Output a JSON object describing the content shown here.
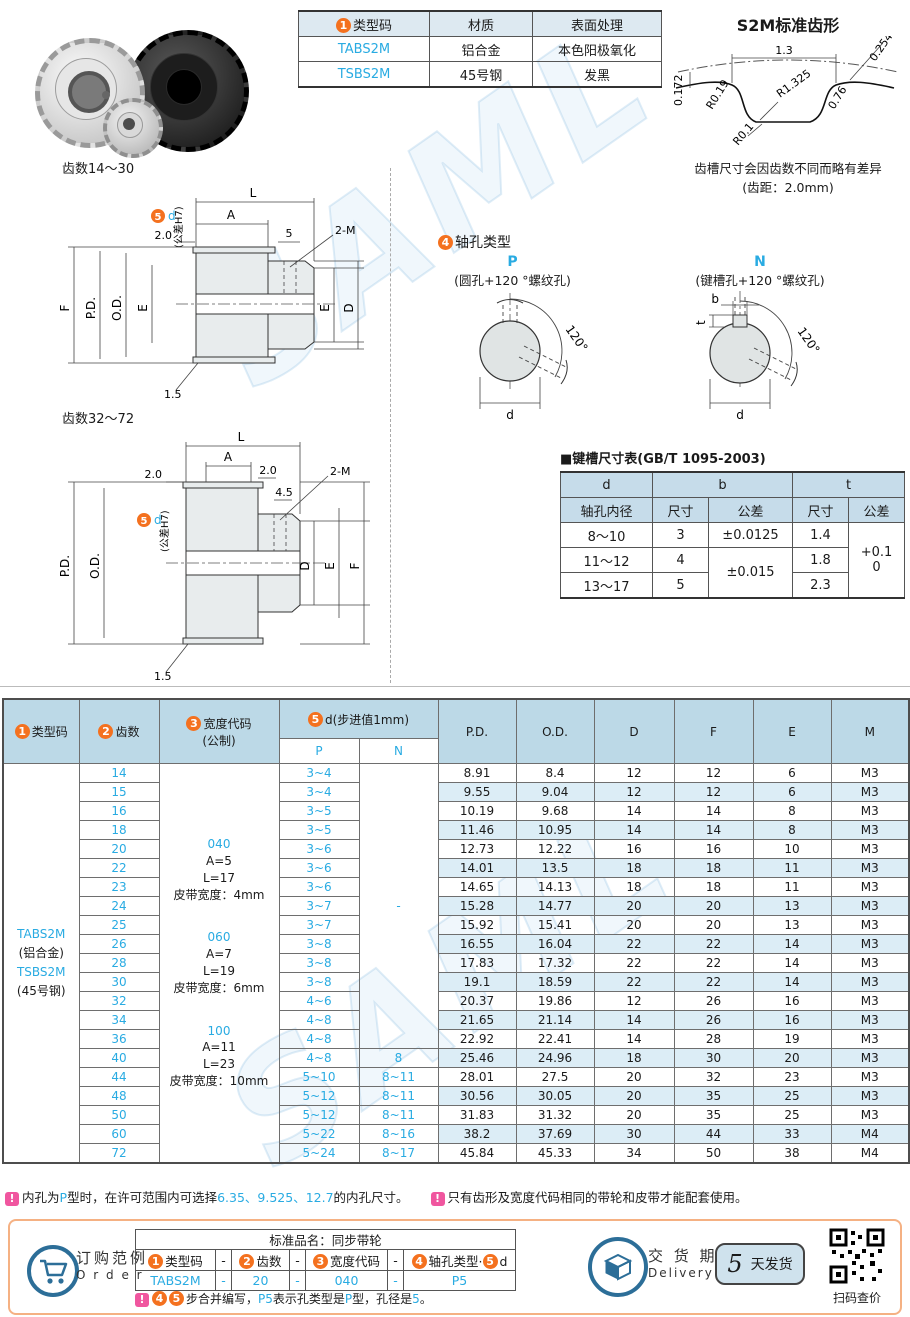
{
  "watermark_text": "SAML",
  "materials_table": {
    "circ": "1",
    "headers": {
      "type": "类型码",
      "material": "材质",
      "surface": "表面处理"
    },
    "rows": [
      {
        "code": "TABS2M",
        "material": "铝合金",
        "surface": "本色阳极氧化"
      },
      {
        "code": "TSBS2M",
        "material": "45号钢",
        "surface": "发黑"
      }
    ]
  },
  "tooth_profile": {
    "title": "S2M标准齿形",
    "dims": {
      "pitch": "1.3",
      "depth": "0.254",
      "r_main": "R1.325",
      "r_tip": "R0.19",
      "flank": "0.76",
      "land": "0.172",
      "r_root": "R0.1"
    },
    "note1": "齿槽尺寸会因齿数不同而略有差异",
    "note2": "(齿距：2.0mm)"
  },
  "drawing1": {
    "title": "齿数14～30",
    "L": "L",
    "A": "A",
    "f20": "2.0",
    "s5": "5",
    "m": "2-M",
    "F": "F",
    "PD": "P.D.",
    "OD": "O.D.",
    "E": "E",
    "E2": "E",
    "D": "D",
    "edge15": "1.5",
    "circ": "5",
    "d": "d",
    "tol": "(公差H7)"
  },
  "drawing2": {
    "title": "齿数32～72",
    "L": "L",
    "A": "A",
    "l20": "2.0",
    "r20": "2.0",
    "s45": "4.5",
    "m": "2-M",
    "PD": "P.D.",
    "OD": "O.D.",
    "D": "D",
    "E": "E",
    "F": "F",
    "edge15": "1.5",
    "circ": "5",
    "d": "d",
    "tol": "(公差H7)"
  },
  "shaft_hole": {
    "circ": "4",
    "title": "轴孔类型",
    "p": {
      "code": "P",
      "desc": "(圆孔+120 °螺纹孔)",
      "angle": "120°",
      "d": "d"
    },
    "n": {
      "code": "N",
      "desc": "(键槽孔+120 °螺纹孔)",
      "angle": "120°",
      "d": "d",
      "b": "b",
      "t": "t"
    }
  },
  "keyway_table": {
    "title": "■键槽尺寸表(GB/T 1095-2003)",
    "h_d": "d",
    "h_d_sub": "轴孔内径",
    "h_b": "b",
    "h_t": "t",
    "h_size_b": "尺寸",
    "h_tol_b": "公差",
    "h_size_t": "尺寸",
    "h_tol_t": "公差",
    "r1": {
      "d": "8～10",
      "b": "3",
      "b_tol": "±0.0125",
      "t": "1.4"
    },
    "r2": {
      "d": "11～12",
      "b": "4",
      "b_tol": "±0.015",
      "t": "1.8"
    },
    "r3": {
      "d": "13～17",
      "b": "5",
      "t": "2.3"
    },
    "t_tol1": "+0.1",
    "t_tol2": "0"
  },
  "main_table": {
    "circ1": "1",
    "circ2": "2",
    "circ3": "3",
    "circ5": "5",
    "h_type": "类型码",
    "h_teeth": "齿数",
    "h_width1": "宽度代码",
    "h_width2": "(公制)",
    "h_d": "d(步进值1mm)",
    "h_p": "P",
    "h_n": "N",
    "h_pd": "P.D.",
    "h_od": "O.D.",
    "h_D": "D",
    "h_F": "F",
    "h_E": "E",
    "h_M": "M",
    "type_cell": [
      {
        "text": "TABS2M",
        "cyan": true
      },
      {
        "text": "(铝合金)"
      },
      {
        "text": "TSBS2M",
        "cyan": true
      },
      {
        "text": "(45号钢)"
      }
    ],
    "width_groups": [
      {
        "code": "040",
        "a": "A=5",
        "l": "L=17",
        "belt": "皮带宽度：4mm"
      },
      {
        "code": "060",
        "a": "A=7",
        "l": "L=19",
        "belt": "皮带宽度：6mm"
      },
      {
        "code": "100",
        "a": "A=11",
        "l": "L=23",
        "belt": "皮带宽度：10mm"
      }
    ],
    "n_merged_text": "-",
    "rows": [
      {
        "teeth": "14",
        "p": "3~4",
        "n_span": 15,
        "pd": "8.91",
        "od": "8.4",
        "d": "12",
        "f": "12",
        "e": "6",
        "m": "M3"
      },
      {
        "teeth": "15",
        "p": "3~4",
        "pd": "9.55",
        "od": "9.04",
        "d": "12",
        "f": "12",
        "e": "6",
        "m": "M3"
      },
      {
        "teeth": "16",
        "p": "3~5",
        "pd": "10.19",
        "od": "9.68",
        "d": "14",
        "f": "14",
        "e": "8",
        "m": "M3"
      },
      {
        "teeth": "18",
        "p": "3~5",
        "pd": "11.46",
        "od": "10.95",
        "d": "14",
        "f": "14",
        "e": "8",
        "m": "M3"
      },
      {
        "teeth": "20",
        "p": "3~6",
        "pd": "12.73",
        "od": "12.22",
        "d": "16",
        "f": "16",
        "e": "10",
        "m": "M3"
      },
      {
        "teeth": "22",
        "p": "3~6",
        "pd": "14.01",
        "od": "13.5",
        "d": "18",
        "f": "18",
        "e": "11",
        "m": "M3"
      },
      {
        "teeth": "23",
        "p": "3~6",
        "pd": "14.65",
        "od": "14.13",
        "d": "18",
        "f": "18",
        "e": "11",
        "m": "M3"
      },
      {
        "teeth": "24",
        "p": "3~7",
        "pd": "15.28",
        "od": "14.77",
        "d": "20",
        "f": "20",
        "e": "13",
        "m": "M3"
      },
      {
        "teeth": "25",
        "p": "3~7",
        "pd": "15.92",
        "od": "15.41",
        "d": "20",
        "f": "20",
        "e": "13",
        "m": "M3"
      },
      {
        "teeth": "26",
        "p": "3~8",
        "pd": "16.55",
        "od": "16.04",
        "d": "22",
        "f": "22",
        "e": "14",
        "m": "M3"
      },
      {
        "teeth": "28",
        "p": "3~8",
        "pd": "17.83",
        "od": "17.32",
        "d": "22",
        "f": "22",
        "e": "14",
        "m": "M3"
      },
      {
        "teeth": "30",
        "p": "3~8",
        "pd": "19.1",
        "od": "18.59",
        "d": "22",
        "f": "22",
        "e": "14",
        "m": "M3"
      },
      {
        "teeth": "32",
        "p": "4~6",
        "pd": "20.37",
        "od": "19.86",
        "d": "12",
        "f": "26",
        "e": "16",
        "m": "M3"
      },
      {
        "teeth": "34",
        "p": "4~8",
        "pd": "21.65",
        "od": "21.14",
        "d": "14",
        "f": "26",
        "e": "16",
        "m": "M3"
      },
      {
        "teeth": "36",
        "p": "4~8",
        "pd": "22.92",
        "od": "22.41",
        "d": "14",
        "f": "28",
        "e": "19",
        "m": "M3"
      },
      {
        "teeth": "40",
        "p": "4~8",
        "n": "8",
        "pd": "25.46",
        "od": "24.96",
        "d": "18",
        "f": "30",
        "e": "20",
        "m": "M3"
      },
      {
        "teeth": "44",
        "p": "5~10",
        "n": "8~11",
        "pd": "28.01",
        "od": "27.5",
        "d": "20",
        "f": "32",
        "e": "23",
        "m": "M3"
      },
      {
        "teeth": "48",
        "p": "5~12",
        "n": "8~11",
        "pd": "30.56",
        "od": "30.05",
        "d": "20",
        "f": "35",
        "e": "25",
        "m": "M3"
      },
      {
        "teeth": "50",
        "p": "5~12",
        "n": "8~11",
        "pd": "31.83",
        "od": "31.32",
        "d": "20",
        "f": "35",
        "e": "25",
        "m": "M3"
      },
      {
        "teeth": "60",
        "p": "5~22",
        "n": "8~16",
        "pd": "38.2",
        "od": "37.69",
        "d": "30",
        "f": "44",
        "e": "33",
        "m": "M4"
      },
      {
        "teeth": "72",
        "p": "5~24",
        "n": "8~17",
        "pd": "45.84",
        "od": "45.33",
        "d": "34",
        "f": "50",
        "e": "38",
        "m": "M4"
      }
    ]
  },
  "warn_icon": "!",
  "notes": {
    "n1": {
      "p0": "内孔为",
      "p1": "P",
      "p2": "型时，在许可范围内可选择",
      "p3": "6.35、9.525、12.7",
      "p4": "的内孔尺寸。"
    },
    "n2": "只有齿形及宽度代码相同的带轮和皮带才能配套使用。"
  },
  "order": {
    "label_cn": "订购范例",
    "label_en": "O r d e r",
    "title": "标准品名：同步带轮",
    "circ1": "1",
    "circ2": "2",
    "circ3": "3",
    "circ4": "4",
    "circ5": "5",
    "h1": "类型码",
    "h2": "齿数",
    "h3": "宽度代码",
    "h4a": "轴孔类型",
    "h4dot": "·",
    "h4b": "d",
    "dash": "-",
    "v1": "TABS2M",
    "v2": "20",
    "v3": "040",
    "v4": "P5",
    "note": {
      "p0": "步合并编写，",
      "p1": "P5",
      "p2": "表示孔类型是",
      "p3": "P",
      "p4": "型，孔径是",
      "p5": "5",
      "p6": "。"
    }
  },
  "delivery": {
    "label_cn": "交 货 期",
    "label_en": "Delivery",
    "days": "5",
    "unit": "天发货"
  },
  "qr_caption": "扫码查价"
}
